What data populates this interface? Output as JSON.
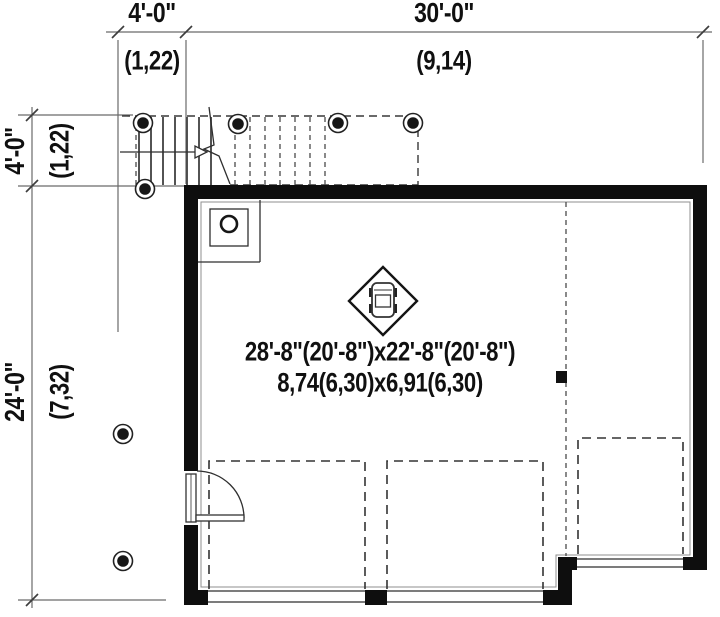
{
  "plan": {
    "type": "garage-floor-plan",
    "colors": {
      "wall": "#0e0e0e",
      "line": "#6a6a6a",
      "dash": "#383838",
      "text": "#101010",
      "bg": "#ffffff"
    },
    "dim_top_offset": {
      "ft": "4'-0\"",
      "m": "(1,22)"
    },
    "dim_top_width": {
      "ft": "30'-0\"",
      "m": "(9,14)"
    },
    "dim_left_offset": {
      "ft": "4'-0\"",
      "m": "(1,22)"
    },
    "dim_left_height": {
      "ft": "24'-0\"",
      "m": "(7,32)"
    },
    "room_label": {
      "imperial": "28'-8\"(20'-8\")x22'-8\"(20'-8\")",
      "metric": "8,74(6,30)x6,91(6,30)"
    }
  }
}
